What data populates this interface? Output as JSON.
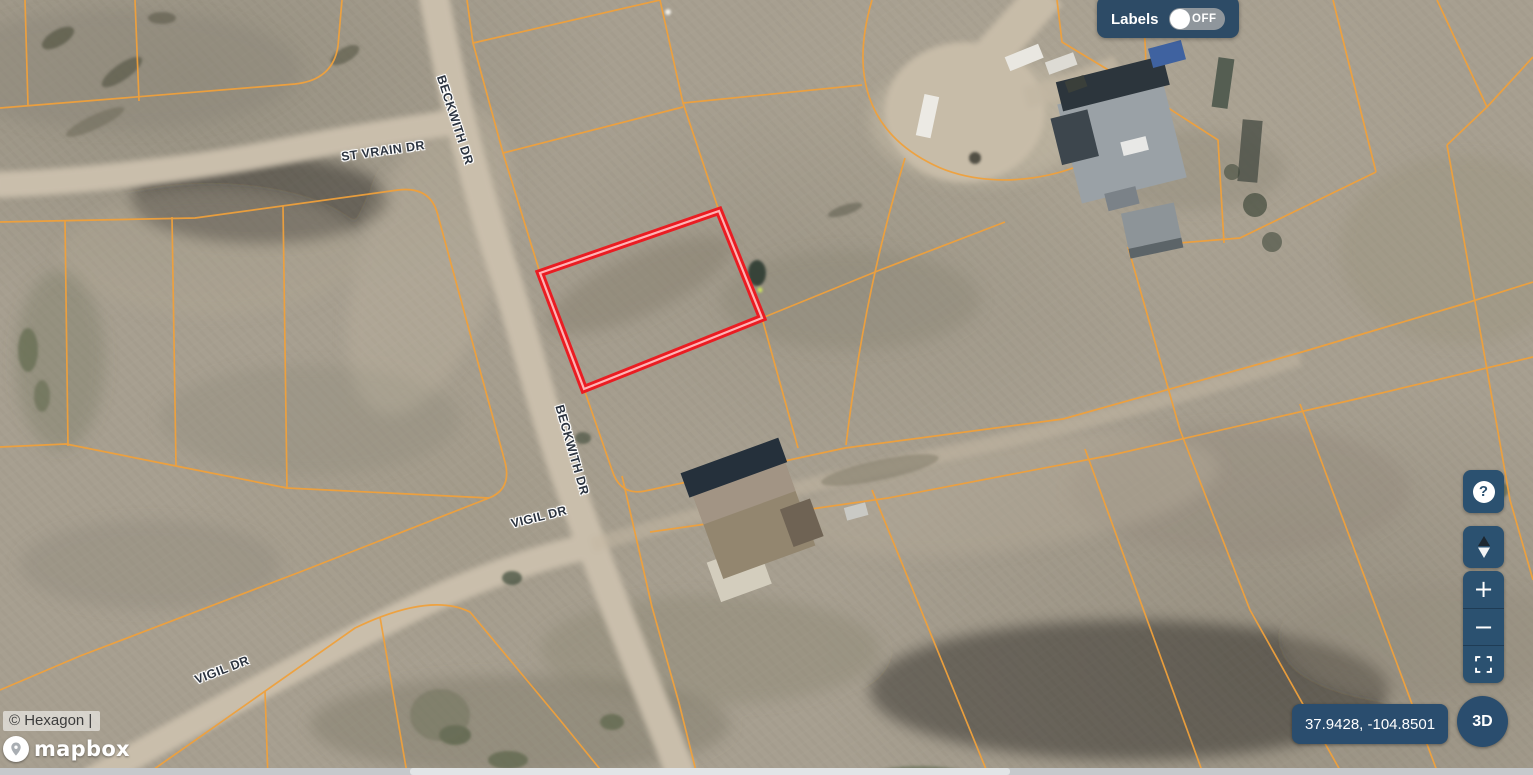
{
  "map": {
    "street_labels": [
      {
        "text": "ST VRAIN DR"
      },
      {
        "text": "BECKWITH DR"
      },
      {
        "text": "BECKWITH DR"
      },
      {
        "text": "VIGIL DR"
      },
      {
        "text": "VIGIL DR"
      }
    ],
    "selected_parcel_outline_color": "#ea1c22",
    "parcel_line_color": "#f0a13c"
  },
  "controls": {
    "labels_toggle": {
      "label": "Labels",
      "state": "OFF"
    },
    "help_label": "?",
    "zoom_in_label": "+",
    "zoom_out_label": "−",
    "coordinates": "37.9428, -104.8501",
    "view_3d_label": "3D"
  },
  "attribution": {
    "provider": "© Hexagon |",
    "logo_text": "mapbox"
  },
  "colors": {
    "panel": "#2d4b66",
    "button": "#2b5170",
    "coords_pill": "#2a4d6e"
  }
}
